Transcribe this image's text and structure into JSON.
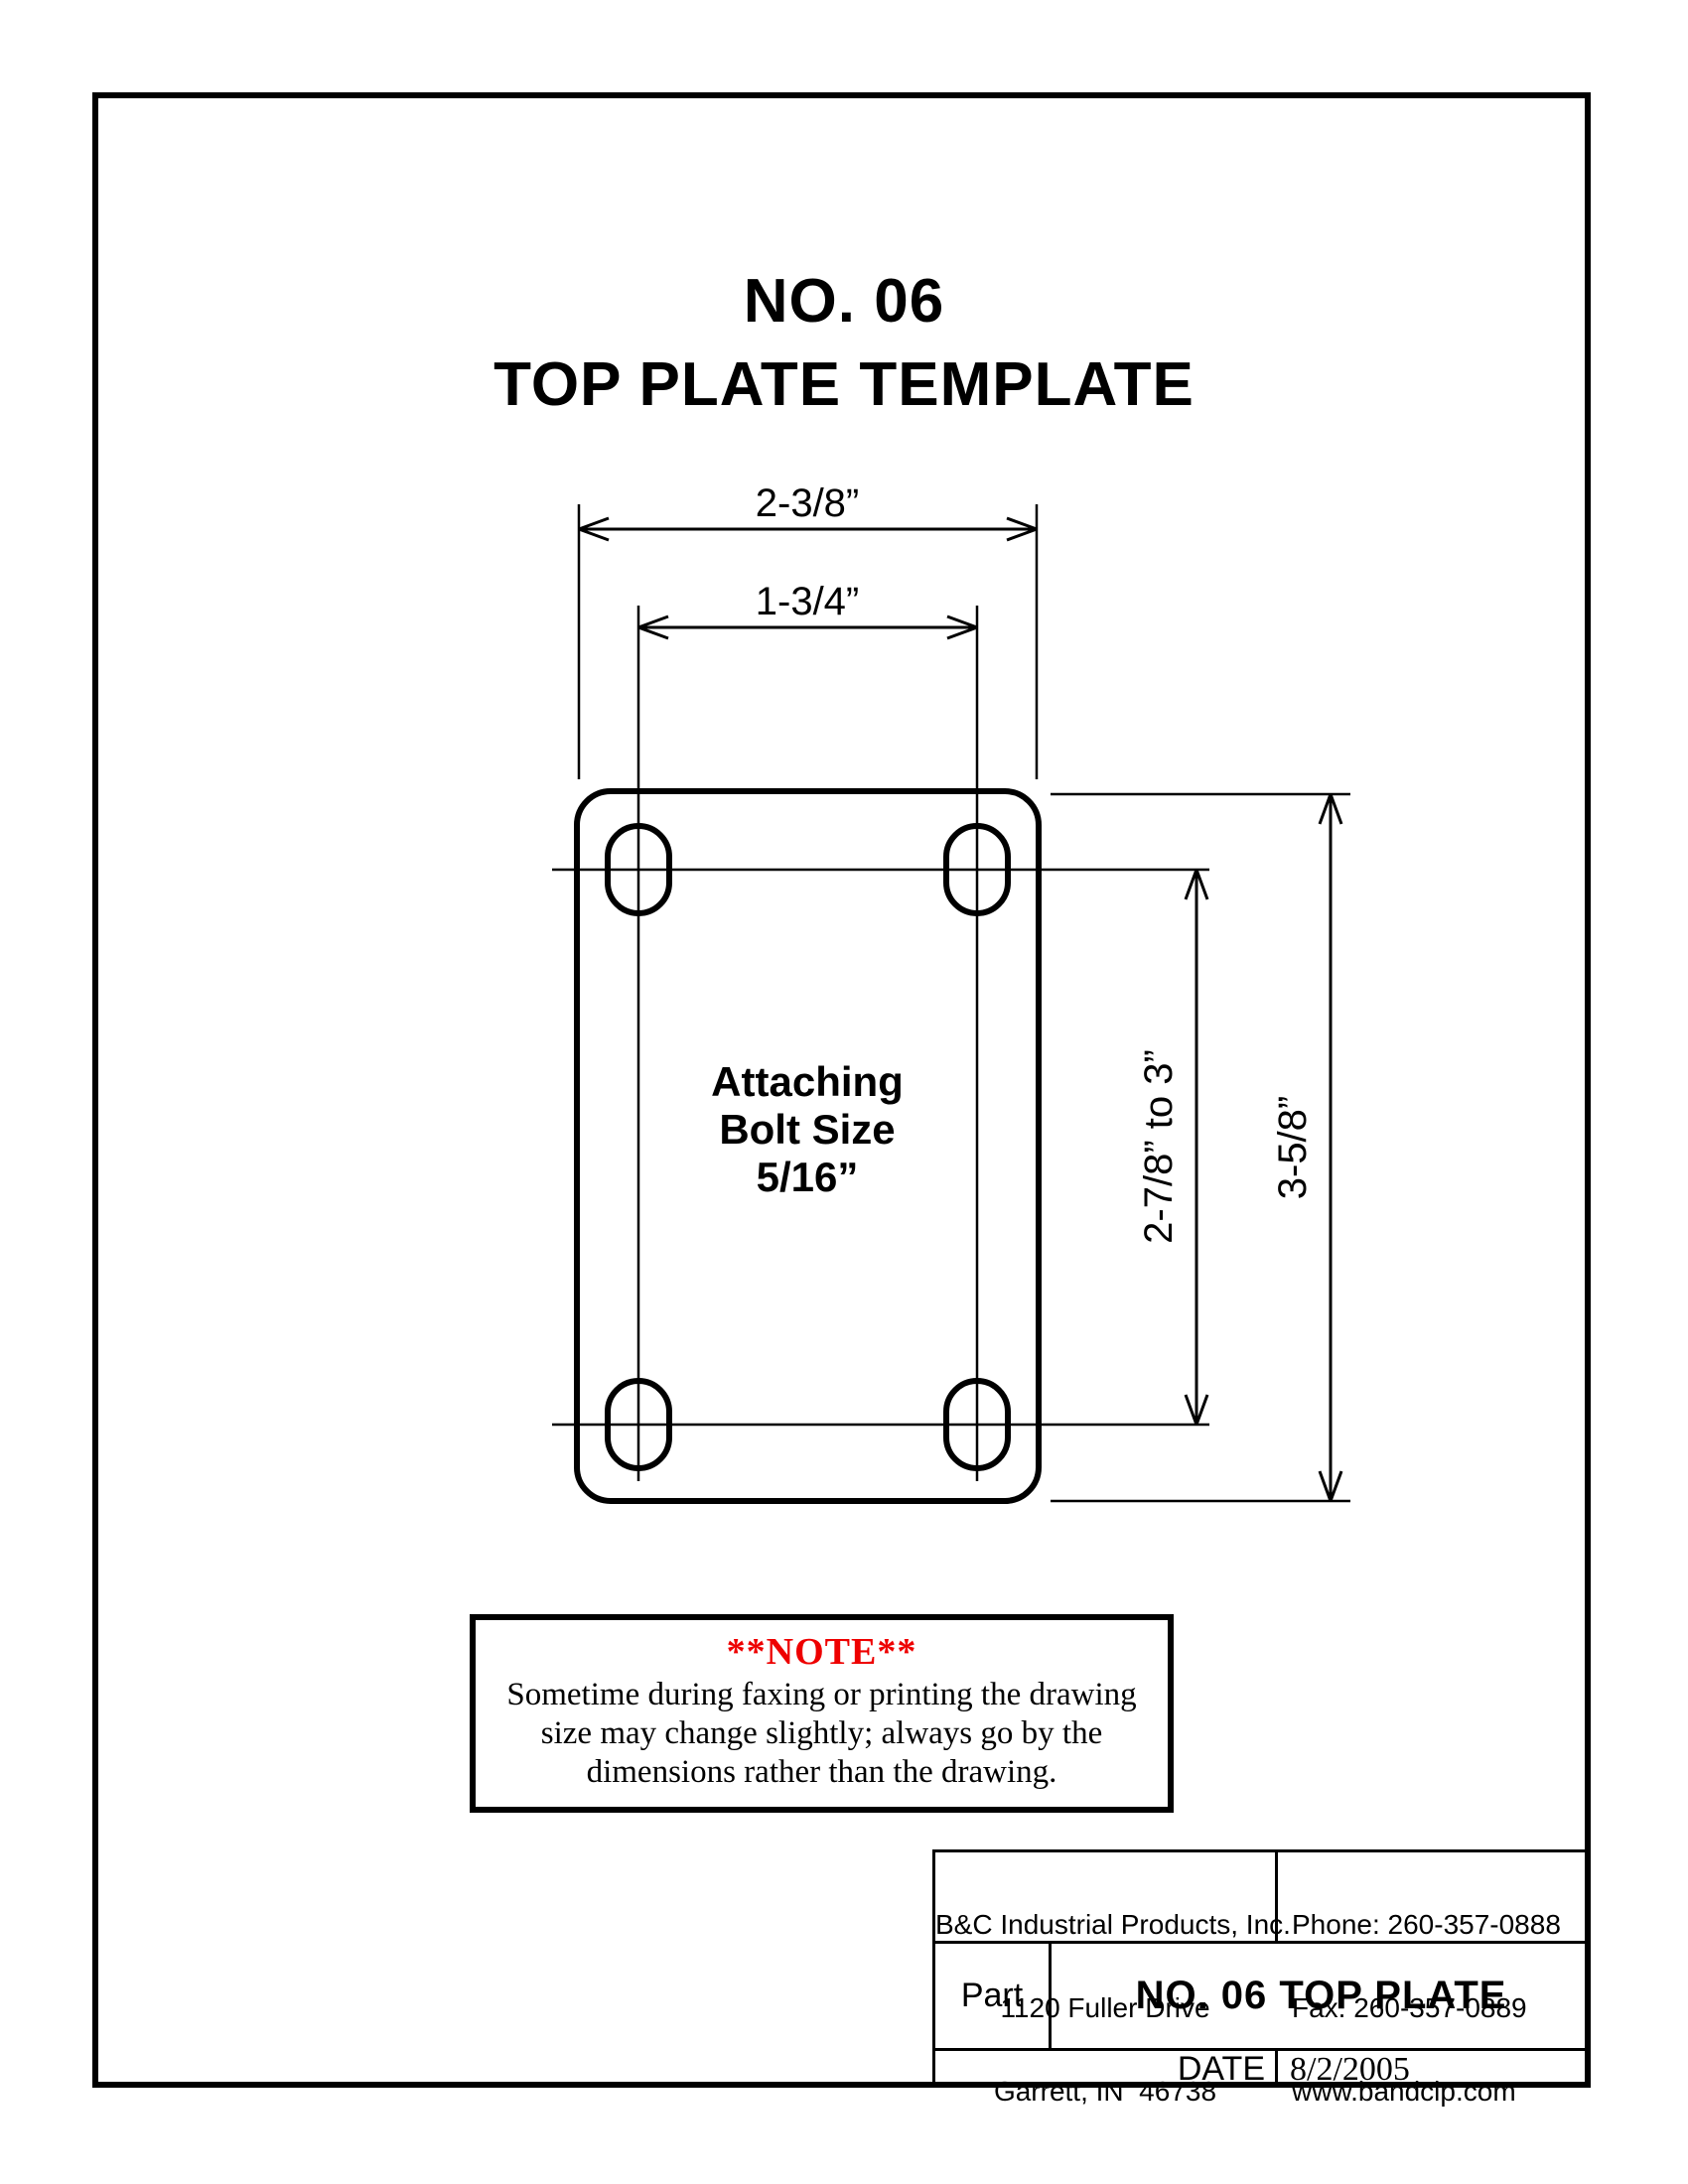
{
  "page": {
    "title_line1": "NO. 06",
    "title_line2": "TOP PLATE TEMPLATE"
  },
  "drawing": {
    "dim_width_outer": "2-3/8”",
    "dim_width_inner": "1-3/4”",
    "dim_height_inner": "2-7/8” to 3”",
    "dim_height_outer": "3-5/8”",
    "plate_label": [
      "Attaching",
      "Bolt Size",
      "5/16”"
    ]
  },
  "note": {
    "heading": "**NOTE**",
    "heading_color": "#ee0000",
    "lines": [
      "Sometime during faxing or printing the drawing",
      "size may change slightly; always go by the",
      "dimensions rather than the drawing."
    ]
  },
  "title_block": {
    "company": {
      "name": "B&C Industrial Products, Inc.",
      "address1": "1120 Fuller Drive",
      "address2": "Garrett, IN  46738"
    },
    "contact": {
      "phone": "Phone: 260-357-0888",
      "fax": "Fax: 260-357-0889",
      "website": "www.bandcip.com"
    },
    "part_label": "Part",
    "part_name": "NO. 06 TOP PLATE",
    "date_label": "DATE",
    "date_value": "8/2/2005"
  }
}
